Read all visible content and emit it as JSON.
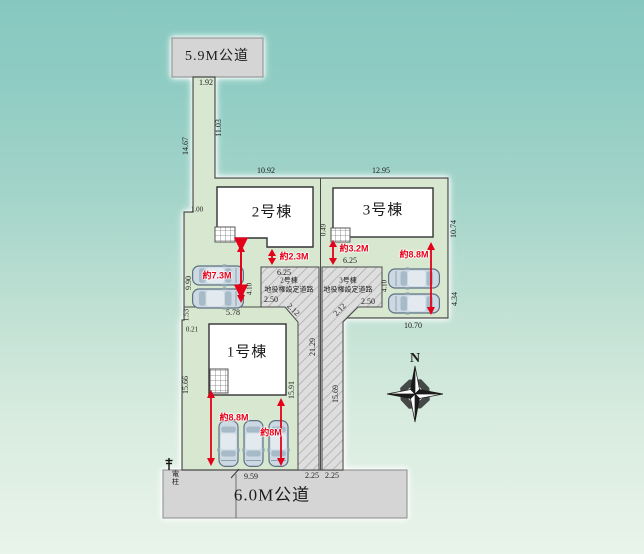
{
  "site_plan": {
    "roads": {
      "top": "5.9M公道",
      "bottom": "6.0M公道"
    },
    "buildings": {
      "b1": "1号棟",
      "b2": "2号棟",
      "b3": "3号棟"
    },
    "easements": {
      "left": {
        "line1": "2号棟",
        "line2": "地役権設定道路"
      },
      "right": {
        "line1": "3号棟",
        "line2": "地役権設定道路"
      }
    },
    "compass": {
      "label": "N"
    },
    "utility_pole": "電柱",
    "red_dims": {
      "d73": "約7.3M",
      "d23": "約2.3M",
      "d32": "約3.2M",
      "d88r": "約8.8M",
      "d88b": "約8.8M",
      "d8": "約8M"
    },
    "dims": {
      "v192": "1.92",
      "v1103": "11.03",
      "v1467": "14.67",
      "v1092": "10.92",
      "v1295": "12.95",
      "v100": "1.00",
      "v049": "0.49",
      "v1074": "10.74",
      "v990": "9.90",
      "v625L": "6.25",
      "v625R": "6.25",
      "v250L": "2.50",
      "v250R": "2.50",
      "v212L": "2.12",
      "v212R": "2.12",
      "v410L": "4.10",
      "v410R": "4.10",
      "v434": "4.34",
      "v1070": "10.70",
      "v578": "5.78",
      "v153": "1.53",
      "v021": "0.21",
      "v1566": "15.66",
      "v1591": "15.91",
      "v2129": "21.29",
      "v1569": "15.69",
      "v959": "9.59",
      "v225a": "2.25",
      "v225b": "2.25"
    },
    "colors": {
      "accent_red": "#e50019",
      "plot_green": "#d8e7d0",
      "road_gray": "#d5d5d5",
      "building_white": "#ffffff",
      "outline": "#4a4a4a"
    }
  }
}
